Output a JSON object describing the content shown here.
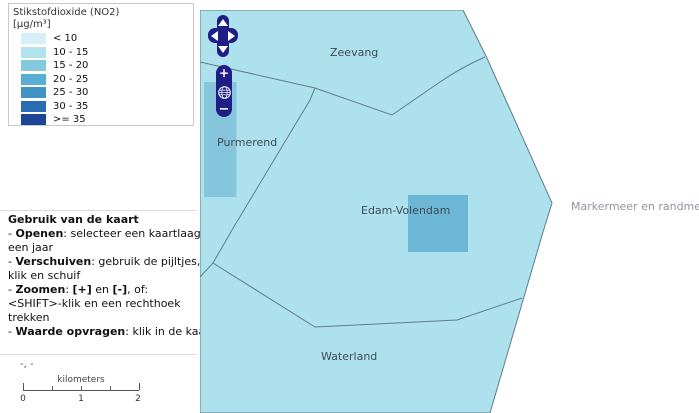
{
  "colors": {
    "navy_control": "#1e1e85",
    "map_base": "#aee1ee",
    "boundary": "#5f7d87",
    "overlay_band": "#86c6dc",
    "overlay_square": "#6db7d6",
    "label_text": "#3d4b54",
    "water_label_text": "#8d959c",
    "panel_divider": "#d9d9d9",
    "legend_border": "#c9c9c9"
  },
  "legend": {
    "title": "Stikstofdioxide (NO2)",
    "subtitle": "[µg/m³]",
    "classes": [
      {
        "label": "< 10",
        "color": "#d6eff8"
      },
      {
        "label": "10 - 15",
        "color": "#b3e2ef"
      },
      {
        "label": "15 - 20",
        "color": "#85c9dd"
      },
      {
        "label": "20 - 25",
        "color": "#58afd3"
      },
      {
        "label": "25 - 30",
        "color": "#4292c6"
      },
      {
        "label": "30 - 35",
        "color": "#2a6cb3"
      },
      {
        "label": ">= 35",
        "color": "#1c4598"
      }
    ]
  },
  "instructions": {
    "title": "Gebruik van de kaart",
    "lines": [
      [
        {
          "t": "- "
        },
        {
          "t": "Openen",
          "b": true
        },
        {
          "t": ": selecteer een kaartlaag en"
        }
      ],
      [
        {
          "t": "een jaar"
        }
      ],
      [
        {
          "t": "- "
        },
        {
          "t": "Verschuiven",
          "b": true
        },
        {
          "t": ": gebruik de pijltjes, of"
        }
      ],
      [
        {
          "t": "klik en schuif"
        }
      ],
      [
        {
          "t": "- "
        },
        {
          "t": "Zoomen",
          "b": true
        },
        {
          "t": ": "
        },
        {
          "t": "[+]",
          "b": true
        },
        {
          "t": " en "
        },
        {
          "t": "[-]",
          "b": true
        },
        {
          "t": ", of:"
        }
      ],
      [
        {
          "t": "<SHIFT>-klik en een rechthoek"
        }
      ],
      [
        {
          "t": "trekken"
        }
      ],
      [
        {
          "t": "- "
        },
        {
          "t": "Waarde opvragen",
          "b": true
        },
        {
          "t": ": klik in de kaart"
        }
      ]
    ]
  },
  "scalebar": {
    "coords_readout": "-, -",
    "unit": "kilometers",
    "tick_labels": [
      "0",
      "1",
      "2"
    ]
  },
  "controls": {
    "zoom_in_label": "+",
    "zoom_out_label": "−"
  },
  "map": {
    "labels": {
      "zeevang": "Zeevang",
      "purmerend": "Purmerend",
      "edam_volendam": "Edam-Volendam",
      "waterland": "Waterland",
      "markermeer": "Markermeer en randmeren"
    }
  }
}
